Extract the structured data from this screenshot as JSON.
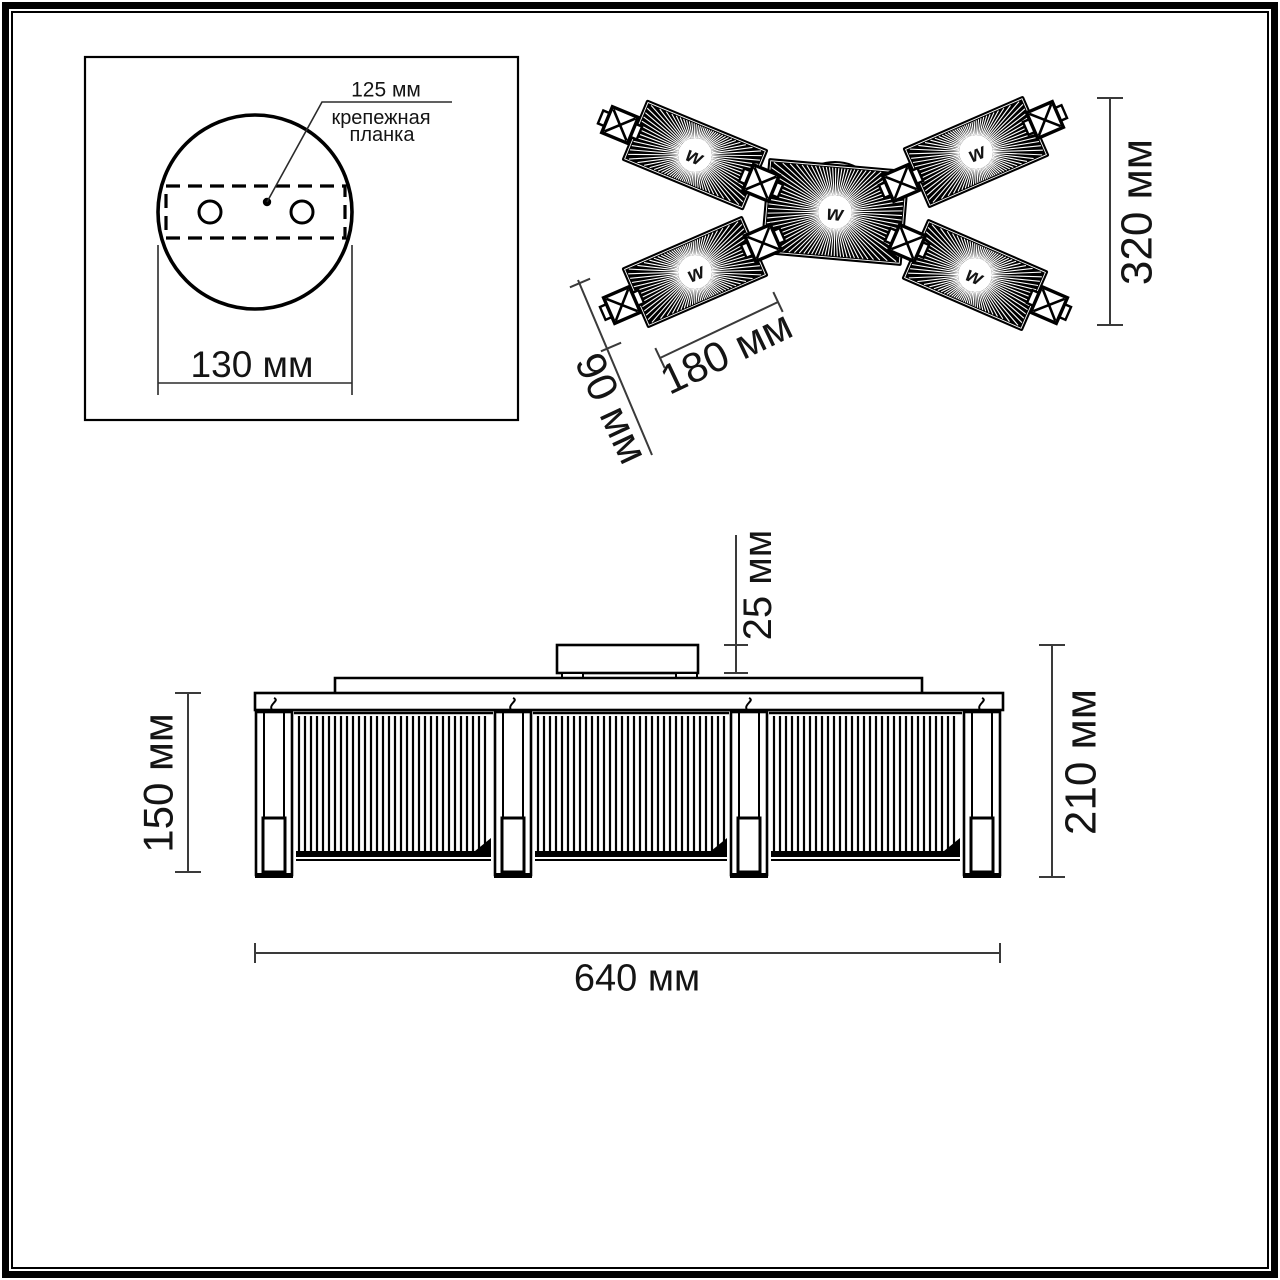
{
  "page": {
    "background": "#ffffff",
    "line_color": "#000000",
    "dim_color": "#3a3a3a"
  },
  "mounting_panel": {
    "dim_125": "125 мм",
    "bracket_label_line1": "крепежная",
    "bracket_label_line2": "планка",
    "dim_130": "130 мм"
  },
  "top_view": {
    "dim_320": "320 мм",
    "dim_180": "180 мм",
    "dim_90": "90 мм",
    "lamp_symbol": "w"
  },
  "side_view": {
    "dim_25": "25 мм",
    "dim_150": "150 мм",
    "dim_210": "210 мм",
    "dim_640": "640 мм"
  }
}
